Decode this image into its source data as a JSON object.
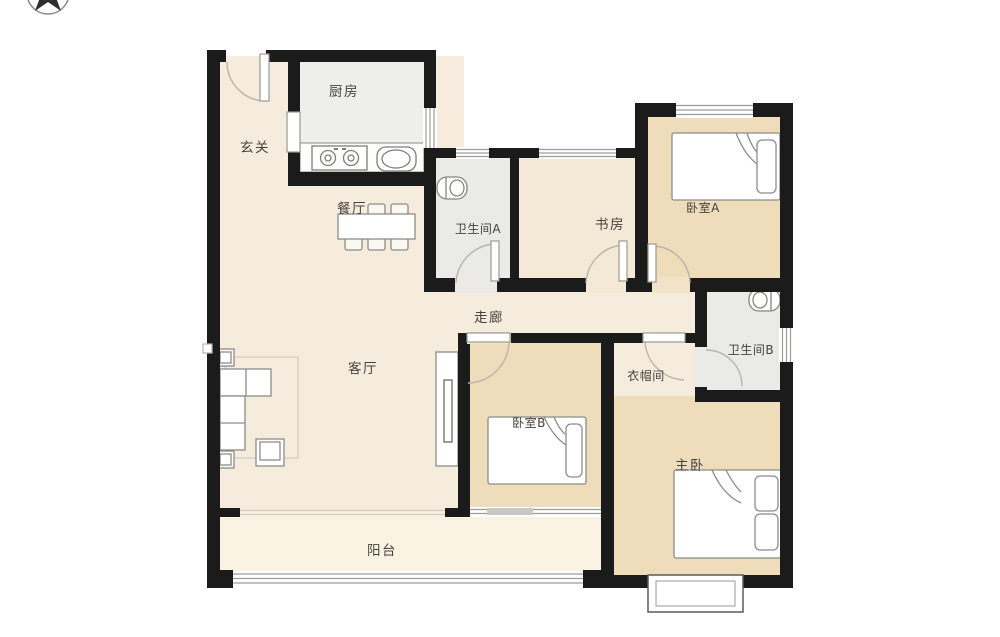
{
  "plan": {
    "type": "apartment-floor-plan",
    "compass": {
      "icon": "north-arrow-compass"
    },
    "colors": {
      "wall": "#1b1b1b",
      "floor_main": "#f6ecdd",
      "floor_bedroom": "#efdcba",
      "floor_wet": "#ebebe9",
      "floor_kitchen": "#eeeeec",
      "floor_balcony": "#faf3e3",
      "furniture_stroke": "#8c8c88"
    },
    "icons": {
      "compass": "north-arrow-compass",
      "bed": "bed-icon",
      "double_bed": "double-bed-icon",
      "toilet": "toilet-icon",
      "sofa": "sofa-set-icon",
      "dining_table": "dining-table-icon",
      "tv_stand": "tv-stand-icon",
      "stove": "stove-icon",
      "sink": "kitchen-sink-icon",
      "bay_window": "bay-window-icon"
    },
    "rooms": [
      {
        "id": "foyer",
        "label": "玄关"
      },
      {
        "id": "kitchen",
        "label": "厨房"
      },
      {
        "id": "dining",
        "label": "餐厅"
      },
      {
        "id": "bathroom_a",
        "label": "卫生间A"
      },
      {
        "id": "study",
        "label": "书房"
      },
      {
        "id": "bedroom_a",
        "label": "卧室A"
      },
      {
        "id": "corridor",
        "label": "走廊"
      },
      {
        "id": "living",
        "label": "客厅"
      },
      {
        "id": "cloakroom",
        "label": "衣帽间"
      },
      {
        "id": "bathroom_b",
        "label": "卫生间B"
      },
      {
        "id": "bedroom_b",
        "label": "卧室B"
      },
      {
        "id": "master",
        "label": "主卧"
      },
      {
        "id": "balcony",
        "label": "阳台"
      }
    ]
  }
}
